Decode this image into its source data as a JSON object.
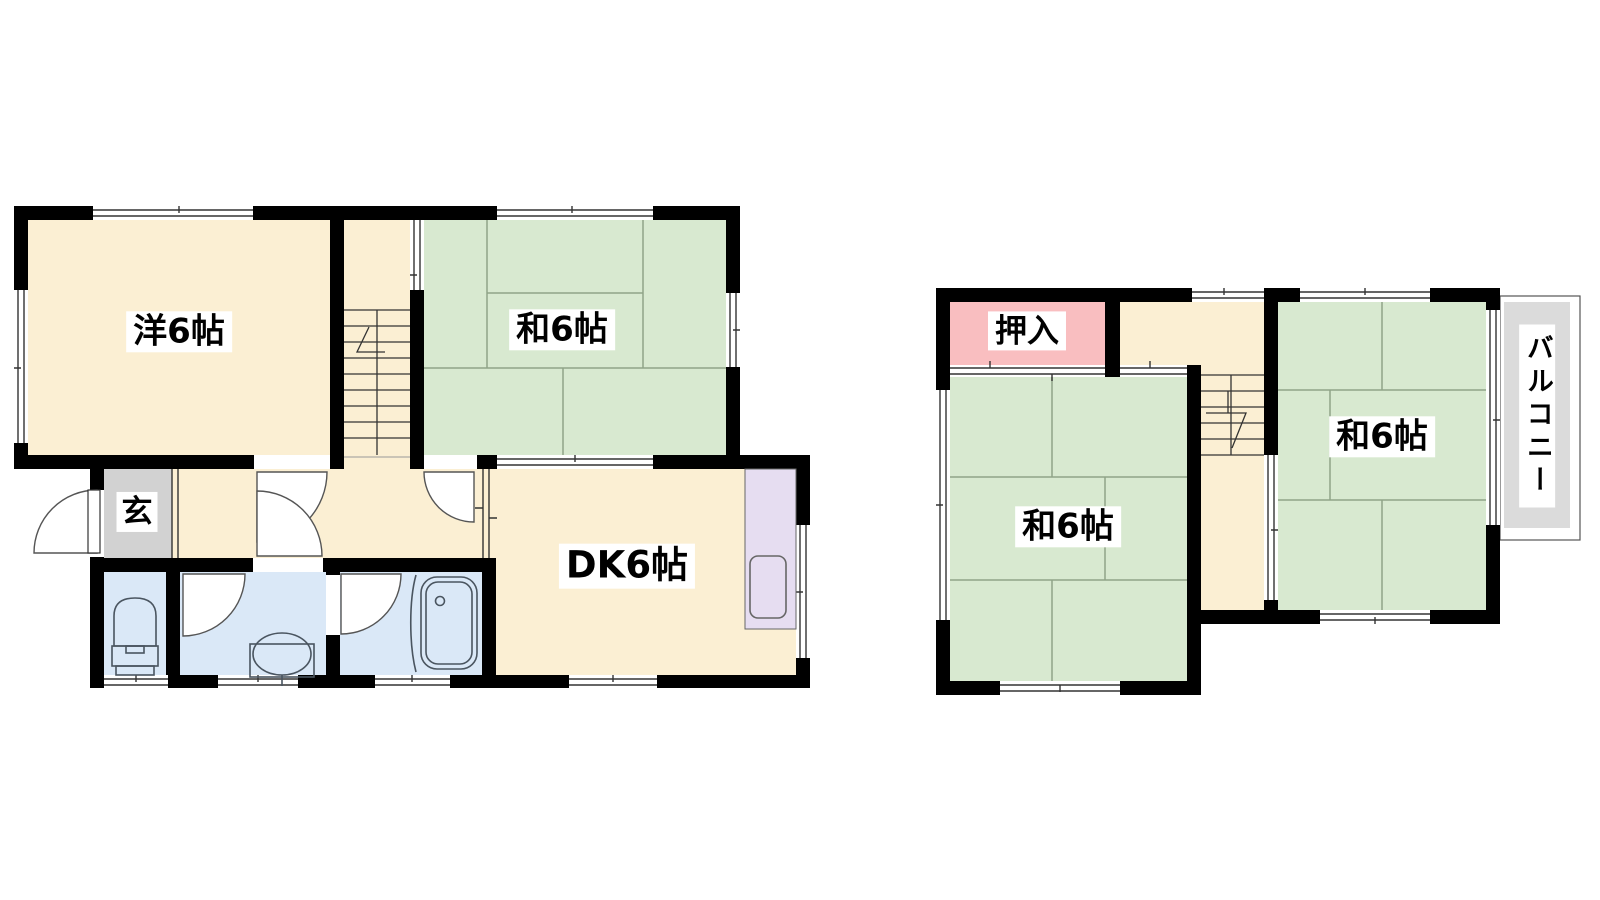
{
  "colors": {
    "wall": "#000000",
    "floor_cream": "#FBEFD3",
    "tatami_green": "#D8E9D0",
    "tatami_line": "#8FA487",
    "closet_pink": "#F9BEC0",
    "bath_blue": "#DAE8F7",
    "kitchen_purple": "#E6DDF1",
    "entrance_gray": "#D2D2D2",
    "balcony_gray": "#DBDBDB",
    "window_line": "#333333",
    "door_stroke": "#555555",
    "fixture_stroke": "#4A5560"
  },
  "floor1": {
    "rooms": {
      "western": {
        "label": "洋6帖"
      },
      "japanese": {
        "label": "和6帖"
      },
      "dining_kitchen": {
        "label": "DK6帖"
      },
      "entrance": {
        "label": "玄"
      }
    }
  },
  "floor2": {
    "rooms": {
      "closet": {
        "label": "押入"
      },
      "japanese_left": {
        "label": "和6帖"
      },
      "japanese_right": {
        "label": "和6帖"
      },
      "balcony": {
        "label": "バルコニー"
      }
    }
  }
}
